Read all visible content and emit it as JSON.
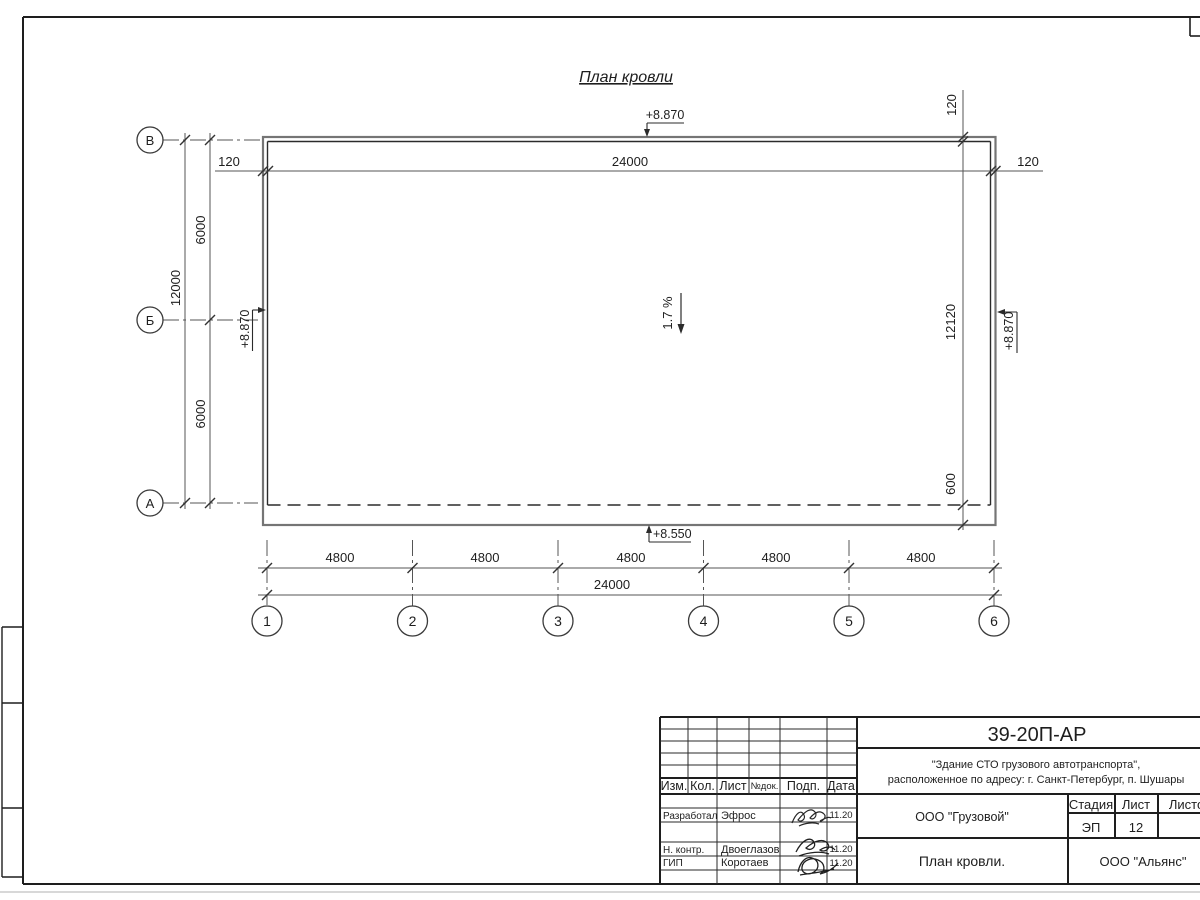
{
  "drawing": {
    "title": "План кровли",
    "slope_label": "1.7 %",
    "elevations": {
      "top": "+8.870",
      "left": "+8.870",
      "right": "+8.870",
      "eave": "+8.550"
    },
    "dims": {
      "overall_top": "24000",
      "parapet_left": "120",
      "parapet_right": "120",
      "parapet_top_right": "120",
      "right_total": "12120",
      "right_overhang": "600",
      "left_total": "12000",
      "left_bay_upper": "6000",
      "left_bay_lower": "6000",
      "bottom_bays": [
        "4800",
        "4800",
        "4800",
        "4800",
        "4800"
      ],
      "overall_bottom": "24000"
    },
    "axes": {
      "letters": [
        "В",
        "Б",
        "А"
      ],
      "numbers": [
        "1",
        "2",
        "3",
        "4",
        "5",
        "6"
      ]
    }
  },
  "titleblock": {
    "doc_number": "39-20П-АР",
    "project_line1": "\"Здание СТО грузового автотранспорта\",",
    "project_line2": "расположенное по адресу: г. Санкт-Петербург, п. Шушары",
    "client": "ООО \"Грузовой\"",
    "sheet_title": "План кровли.",
    "company": "ООО \"Альянс\"",
    "stage_label": "Стадия",
    "sheet_label": "Лист",
    "sheets_label": "Листов",
    "stage_value": "ЭП",
    "sheet_value": "12",
    "header": {
      "izm": "Изм.",
      "kol": "Кол.",
      "list": "Лист",
      "ndok": "№док.",
      "podp": "Подп.",
      "data": "Дата"
    },
    "rows": [
      {
        "role": "Разработал",
        "name": "Эфрос",
        "date": "11.20"
      },
      {
        "role": "Н. контр.",
        "name": "Двоеглазов",
        "date": "11.20"
      },
      {
        "role": "ГИП",
        "name": "Коротаев",
        "date": "11.20"
      }
    ]
  },
  "colors": {
    "frame": "#1e1e1e",
    "wall_outer": "#757575",
    "wall_inner": "#2b2b2b",
    "dim_line": "#555555",
    "text": "#1e1e1e"
  }
}
